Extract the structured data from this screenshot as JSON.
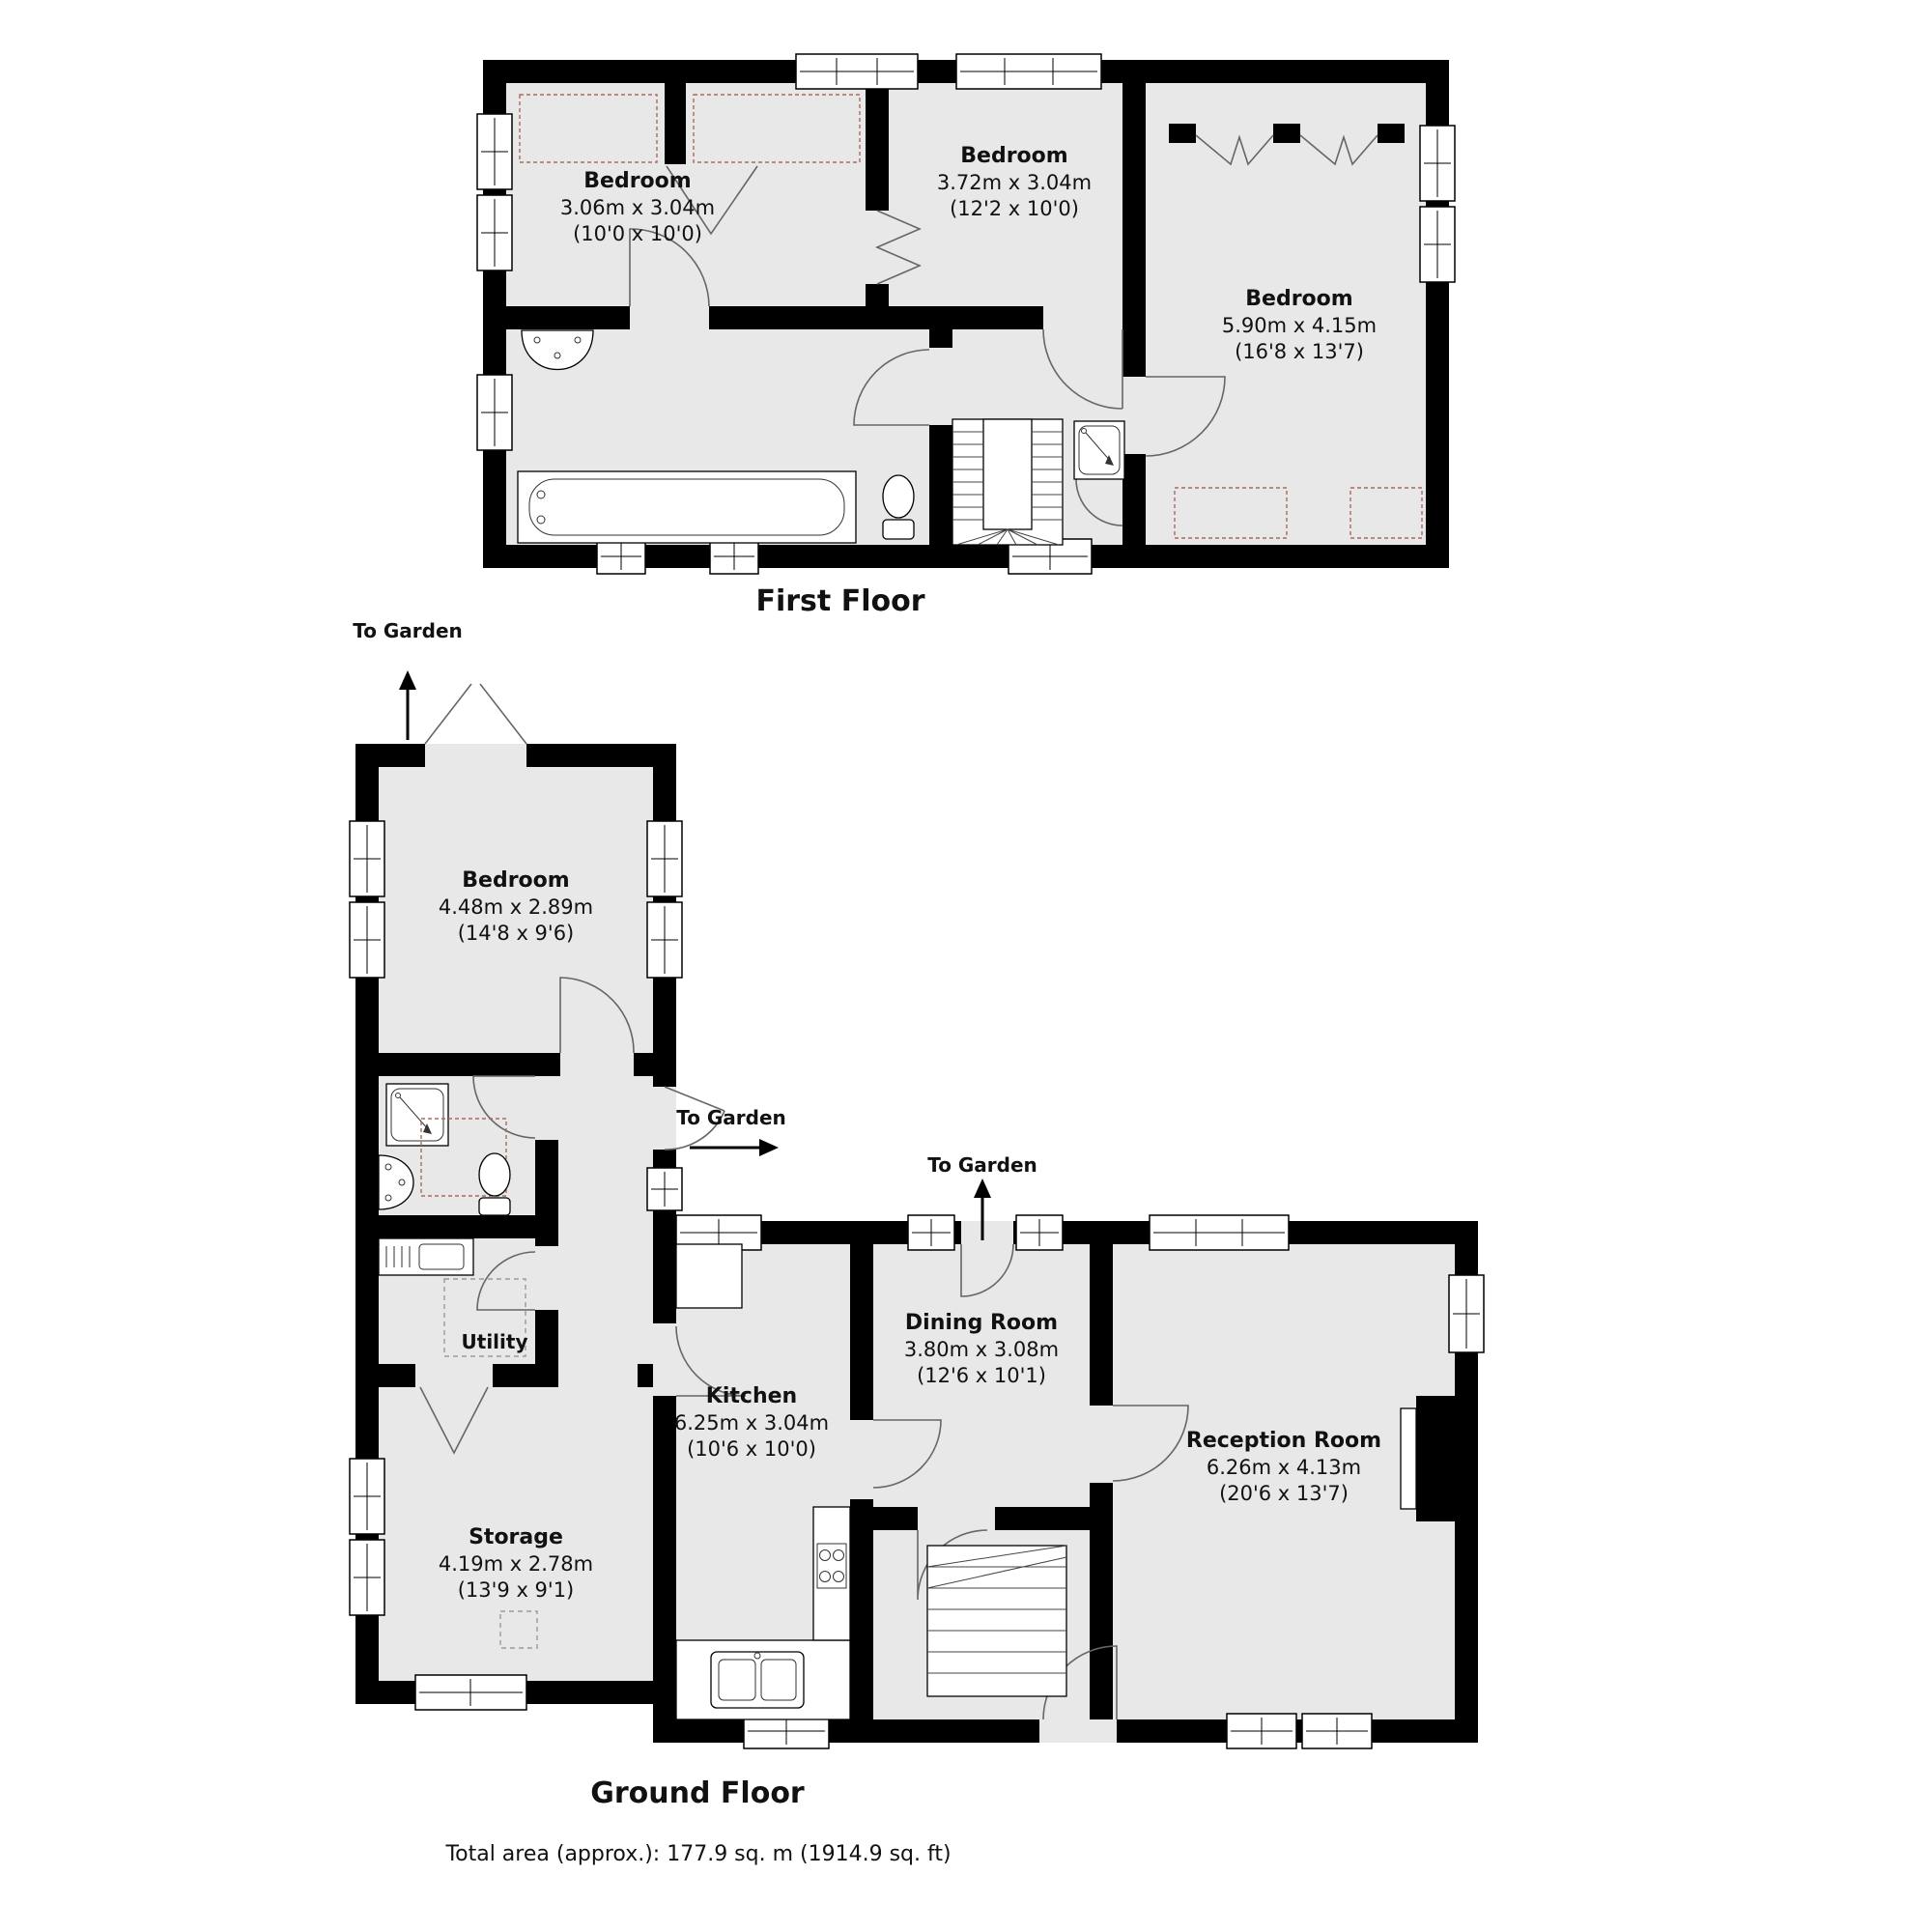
{
  "first_floor": {
    "title": "First Floor",
    "rooms": [
      {
        "name": "Bedroom",
        "metric": "3.06m x 3.04m",
        "imperial": "(10'0 x 10'0)"
      },
      {
        "name": "Bedroom",
        "metric": "3.72m x 3.04m",
        "imperial": "(12'2 x 10'0)"
      },
      {
        "name": "Bedroom",
        "metric": "5.90m x 4.15m",
        "imperial": "(16'8 x 13'7)"
      }
    ]
  },
  "ground_floor": {
    "title": "Ground Floor",
    "rooms": [
      {
        "name": "Bedroom",
        "metric": "4.48m x 2.89m",
        "imperial": "(14'8 x 9'6)"
      },
      {
        "name": "Utility"
      },
      {
        "name": "Storage",
        "metric": "4.19m x 2.78m",
        "imperial": "(13'9 x 9'1)"
      },
      {
        "name": "Kitchen",
        "metric": "6.25m x 3.04m",
        "imperial": "(10'6 x 10'0)"
      },
      {
        "name": "Dining Room",
        "metric": "3.80m x 3.08m",
        "imperial": "(12'6 x 10'1)"
      },
      {
        "name": "Reception Room",
        "metric": "6.26m x 4.13m",
        "imperial": "(20'6 x 13'7)"
      }
    ],
    "garden_labels": [
      "To Garden",
      "To Garden",
      "To Garden"
    ]
  },
  "footer": {
    "total_area": "Total area (approx.): 177.9 sq. m (1914.9 sq. ft)"
  },
  "colors": {
    "wall": "#000000",
    "room_fill": "#e8e8e8",
    "wardrobe_dash": "#aa6a5a",
    "appliance_dash": "#9a9a9a",
    "text": "#111111"
  }
}
